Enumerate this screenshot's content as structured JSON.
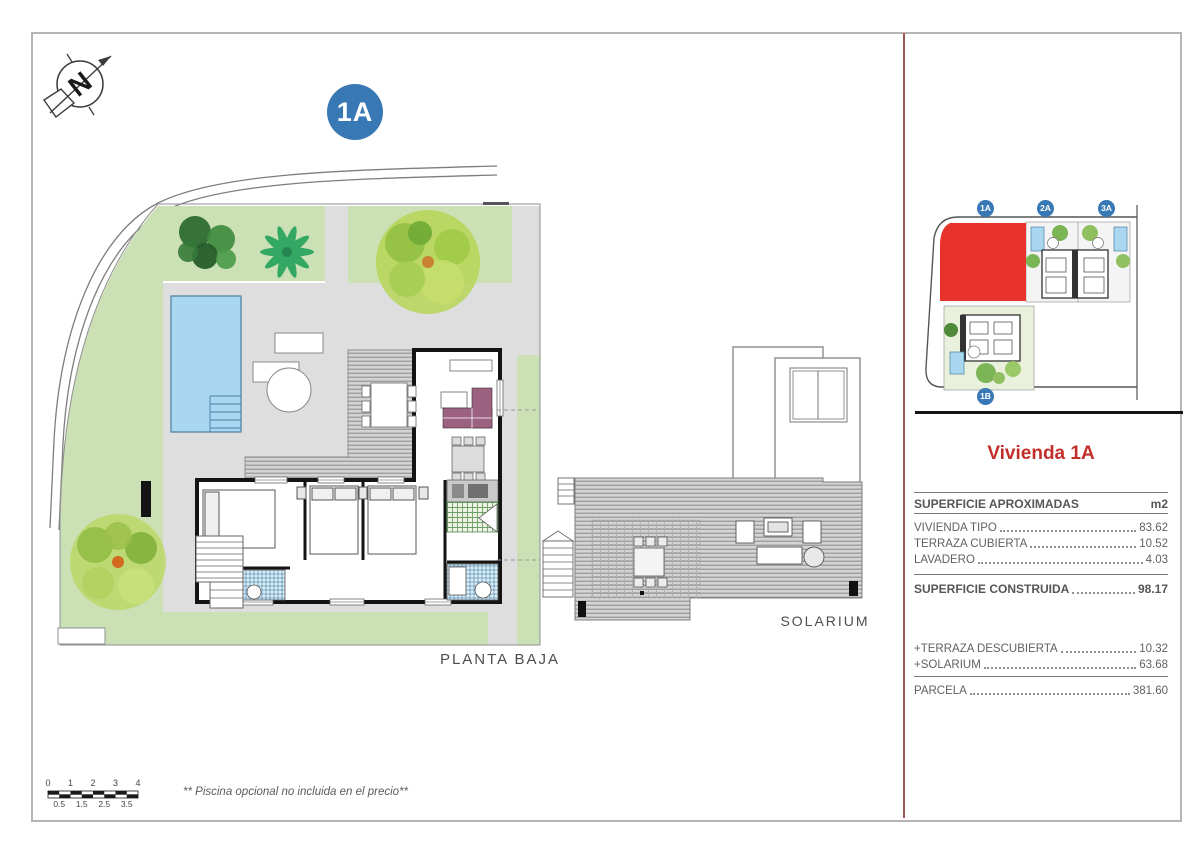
{
  "colors": {
    "accent_blue": "#3878b5",
    "plot_red": "#e8322c",
    "title_red": "#c22f2a",
    "garden_green": "#cbe0b4",
    "pool_blue": "#a9d7f0",
    "sofa_purple": "#9c6080",
    "divider_maroon": "#9a5a50"
  },
  "compass": {
    "letter": "N"
  },
  "badges": {
    "main": "1A"
  },
  "plan": {
    "label": "PLANTA BAJA"
  },
  "solarium": {
    "label": "SOLARIUM"
  },
  "site_plan": {
    "badges": [
      "1A",
      "2A",
      "3A",
      "1B"
    ]
  },
  "sidebar": {
    "title": "Vivienda 1A",
    "table": {
      "header": {
        "label": "SUPERFICIE APROXIMADAS",
        "unit": "m2"
      },
      "rows": [
        {
          "label": "VIVIENDA TIPO",
          "value": "83.62"
        },
        {
          "label": "TERRAZA CUBIERTA",
          "value": "10.52"
        },
        {
          "label": "LAVADERO",
          "value": "4.03"
        }
      ],
      "total": {
        "label": "SUPERFICIE CONSTRUIDA",
        "value": "98.17"
      },
      "extras": [
        {
          "label": "+TERRAZA DESCUBIERTA",
          "value": "10.32"
        },
        {
          "label": "+SOLARIUM",
          "value": "63.68"
        }
      ],
      "parcel": {
        "label": "PARCELA",
        "value": "381.60"
      }
    }
  },
  "scale_bar": {
    "top": [
      "0",
      "1",
      "2",
      "3",
      "4"
    ],
    "bottom": [
      "0.5",
      "1.5",
      "2.5",
      "3.5"
    ]
  },
  "note": {
    "text": "** Piscina opcional no incluida en el precio**"
  }
}
